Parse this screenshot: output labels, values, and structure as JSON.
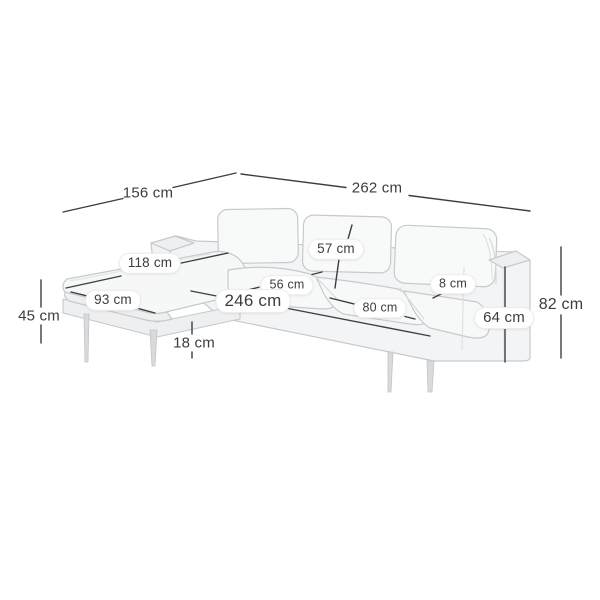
{
  "diagram": {
    "type": "product-dimension-diagram",
    "subject": "corner-sofa-with-longchair",
    "unit": "cm",
    "dimensions": {
      "d156": {
        "value": 156,
        "text": "156 cm"
      },
      "d262": {
        "value": 262,
        "text": "262 cm"
      },
      "d57": {
        "value": 57,
        "text": "57 cm"
      },
      "d118": {
        "value": 118,
        "text": "118 cm"
      },
      "d56": {
        "value": 56,
        "text": "56 cm"
      },
      "d246": {
        "value": 246,
        "text": "246 cm"
      },
      "d93": {
        "value": 93,
        "text": "93 cm"
      },
      "d80": {
        "value": 80,
        "text": "80 cm"
      },
      "d8": {
        "value": 8,
        "text": "8 cm"
      },
      "d45": {
        "value": 45,
        "text": "45 cm"
      },
      "d18": {
        "value": 18,
        "text": "18 cm"
      },
      "d64": {
        "value": 64,
        "text": "64 cm"
      },
      "d82": {
        "value": 82,
        "text": "82 cm"
      }
    }
  }
}
